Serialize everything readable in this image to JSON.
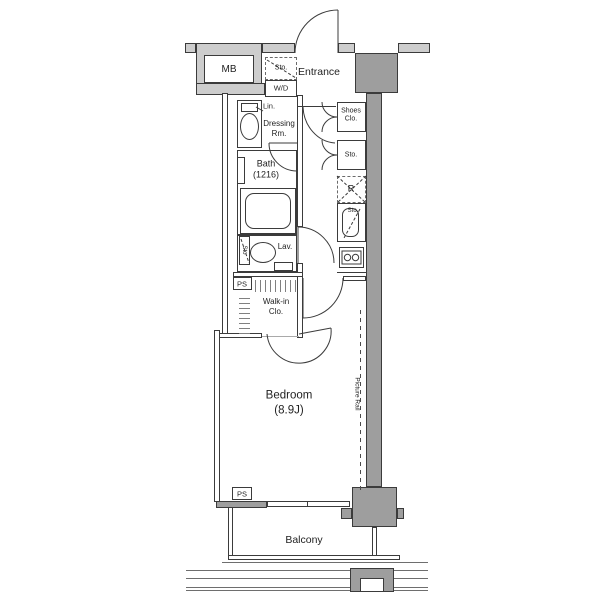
{
  "floorplan": {
    "labels": {
      "mb": "MB",
      "storage_top": "Sto.",
      "washer_dryer": "W/D",
      "entrance": "Entrance",
      "shoes_closet": [
        "Shoes",
        "Clo."
      ],
      "storage_hall": "Sto.",
      "linen": "Lin.",
      "dressing_room": [
        "Dressing",
        "Rm."
      ],
      "bath": [
        "Bath",
        "(1216)"
      ],
      "refrigerator": "R",
      "storage_kitchen": "Sto.",
      "storage_lavatory": "Sto",
      "lavatory": "Lav.",
      "pipe_space_upper": "PS",
      "walk_in_closet": [
        "Walk-in",
        "Clo."
      ],
      "bedroom": [
        "Bedroom",
        "(8.9J)"
      ],
      "picture_rail": "Picture Rail",
      "pipe_space_lower": "PS",
      "balcony": "Balcony"
    },
    "colors": {
      "wall_fill": "#cdcdcd",
      "pillar_fill": "#9e9e9e",
      "line": "#3b3b3b",
      "text": "#1f1f1f",
      "background": "#ffffff"
    }
  }
}
